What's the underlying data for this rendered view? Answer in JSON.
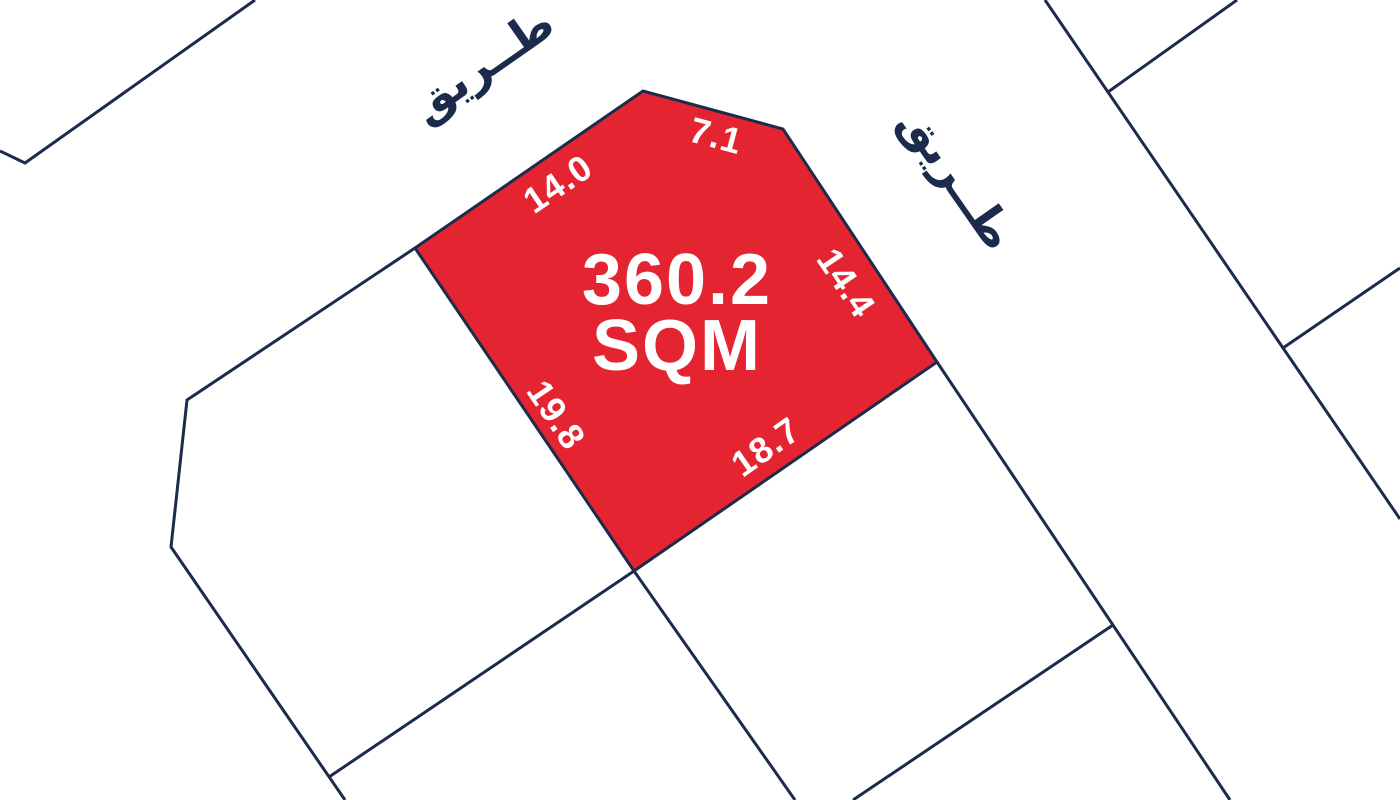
{
  "map": {
    "type": "cadastral-plot-map",
    "background_color": "#ffffff",
    "line_color": "#1c2b4c",
    "roads": [
      {
        "id": "road-top",
        "label": "طــريق"
      },
      {
        "id": "road-right",
        "label": "طــريق"
      }
    ],
    "plot": {
      "area_value": "360.2",
      "area_unit": "SQM",
      "fill_color": "#e42430",
      "label_color": "#ffffff",
      "dimensions": [
        {
          "edge": "top-left",
          "value": "14.0"
        },
        {
          "edge": "top-right",
          "value": "7.1"
        },
        {
          "edge": "right",
          "value": "14.4"
        },
        {
          "edge": "bottom-right",
          "value": "18.7"
        },
        {
          "edge": "bottom-left",
          "value": "19.8"
        }
      ]
    }
  }
}
